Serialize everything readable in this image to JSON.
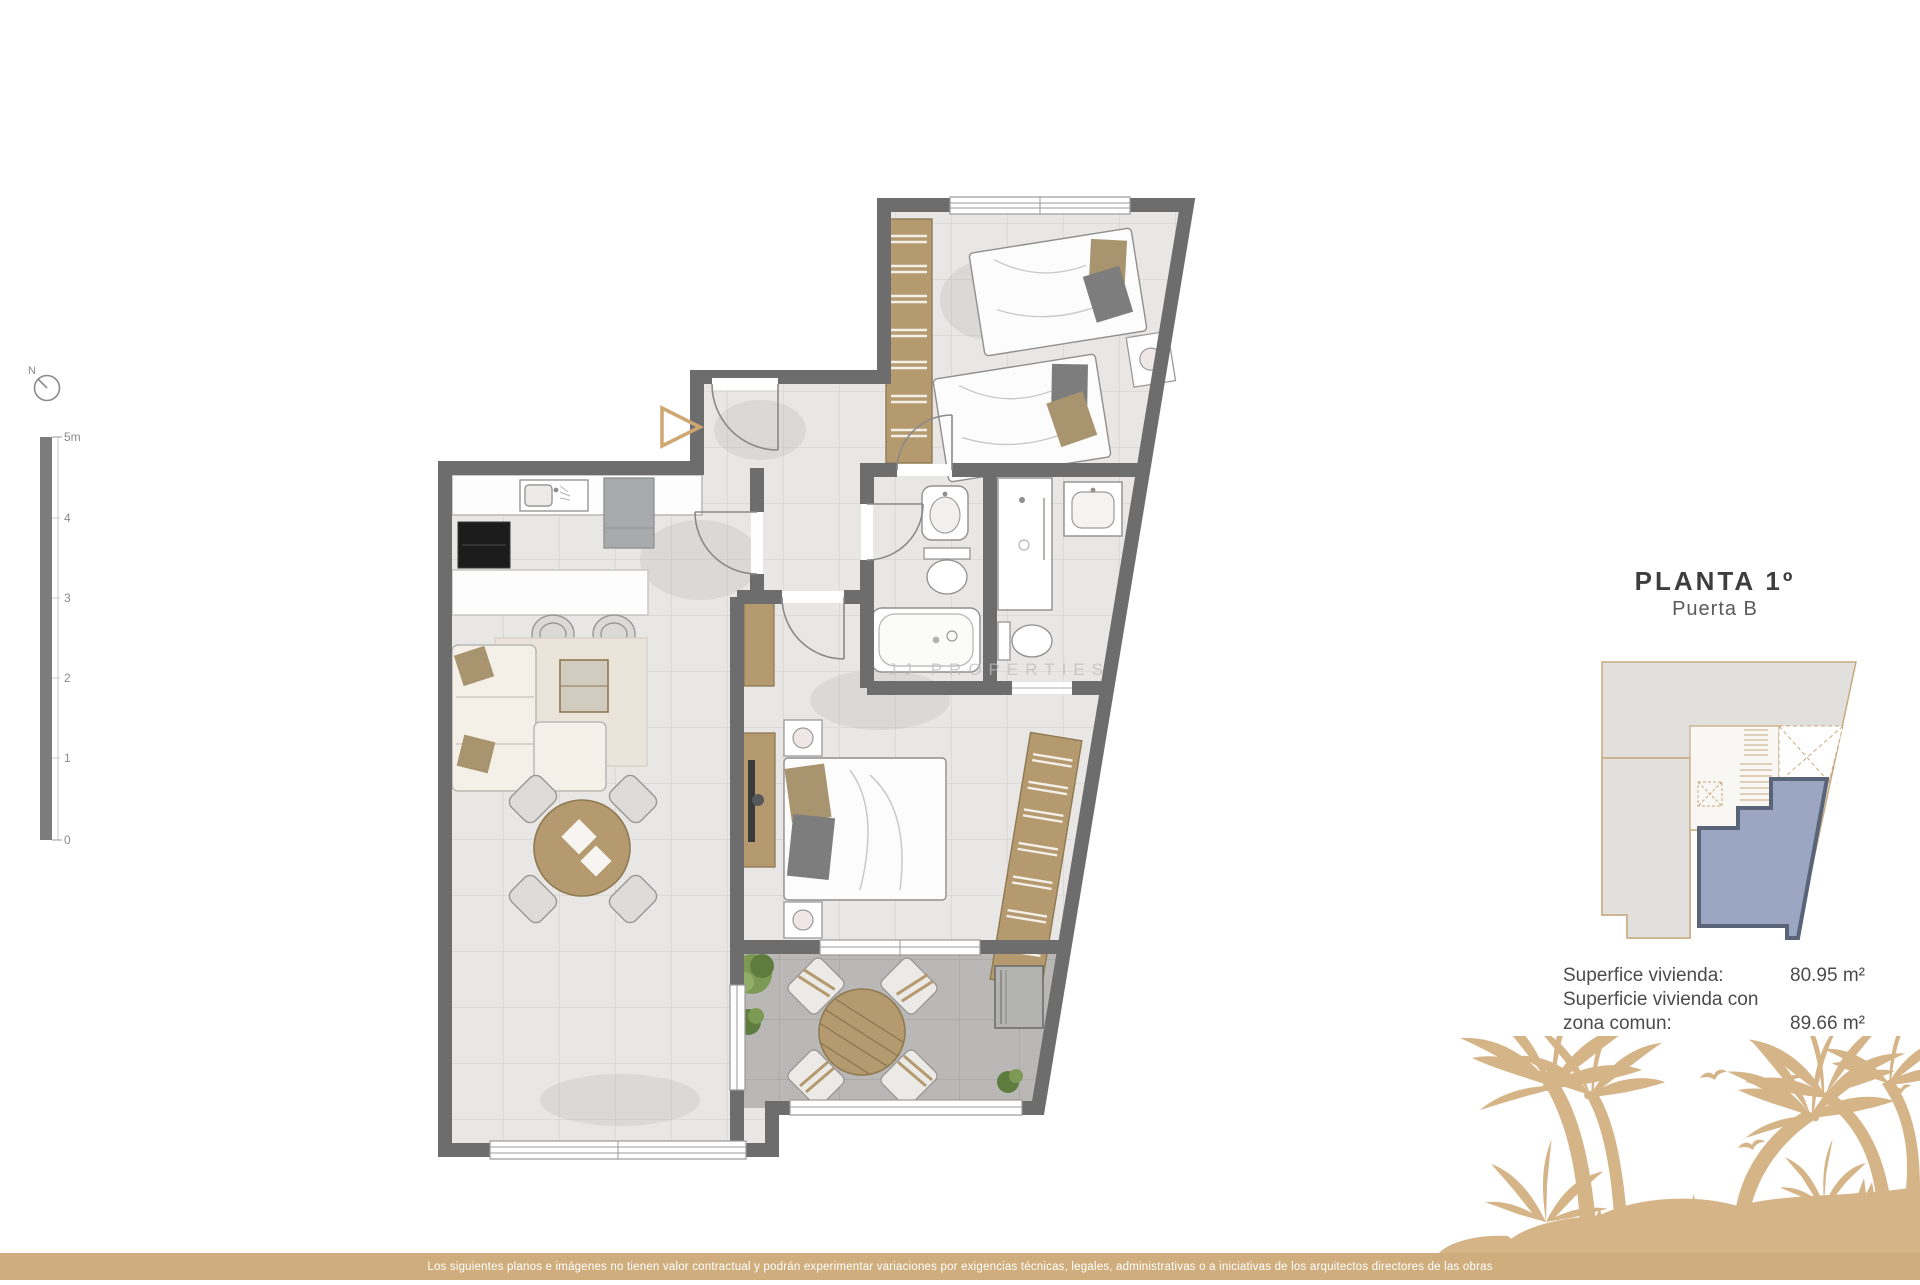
{
  "compass": {
    "label": "N"
  },
  "scale_bar": {
    "labels": [
      "5m",
      "4",
      "3",
      "2",
      "1",
      "0"
    ]
  },
  "watermark": "JJ PROPERTIES",
  "panel": {
    "title": "PLANTA 1º",
    "subtitle": "Puerta B",
    "metrics": [
      {
        "label": "Superfice vivienda:",
        "value": "80.95 m²"
      },
      {
        "label_line1": "Superficie vivienda con",
        "label_line2": "zona comun:",
        "value": "89.66 m²"
      }
    ]
  },
  "footer": {
    "disclaimer": "Los siguientes planos e imágenes no tienen valor contractual y podrán experimentar variaciones por exigencias técnicas, legales, administrativas o a iniciativas de los arquitectos directores de las obras"
  },
  "colors": {
    "wall": "#6d6d6d",
    "floor": "#e8e7e5",
    "terrace_floor": "#b9b8b6",
    "wood": "#b49a6e",
    "gold": "#d0ad7d",
    "palm": "#d5b488",
    "unit_highlight": "#9aa6c2",
    "unit_highlight_border": "#5a6478",
    "keyplan_outline": "#c8a97e",
    "title_text": "#3e3e3e"
  },
  "icons": {
    "compass": "compass-icon",
    "entry_arrow": "entry-arrow-icon",
    "palm_trees": "palm-trees-graphic",
    "birds": "birds-graphic"
  }
}
